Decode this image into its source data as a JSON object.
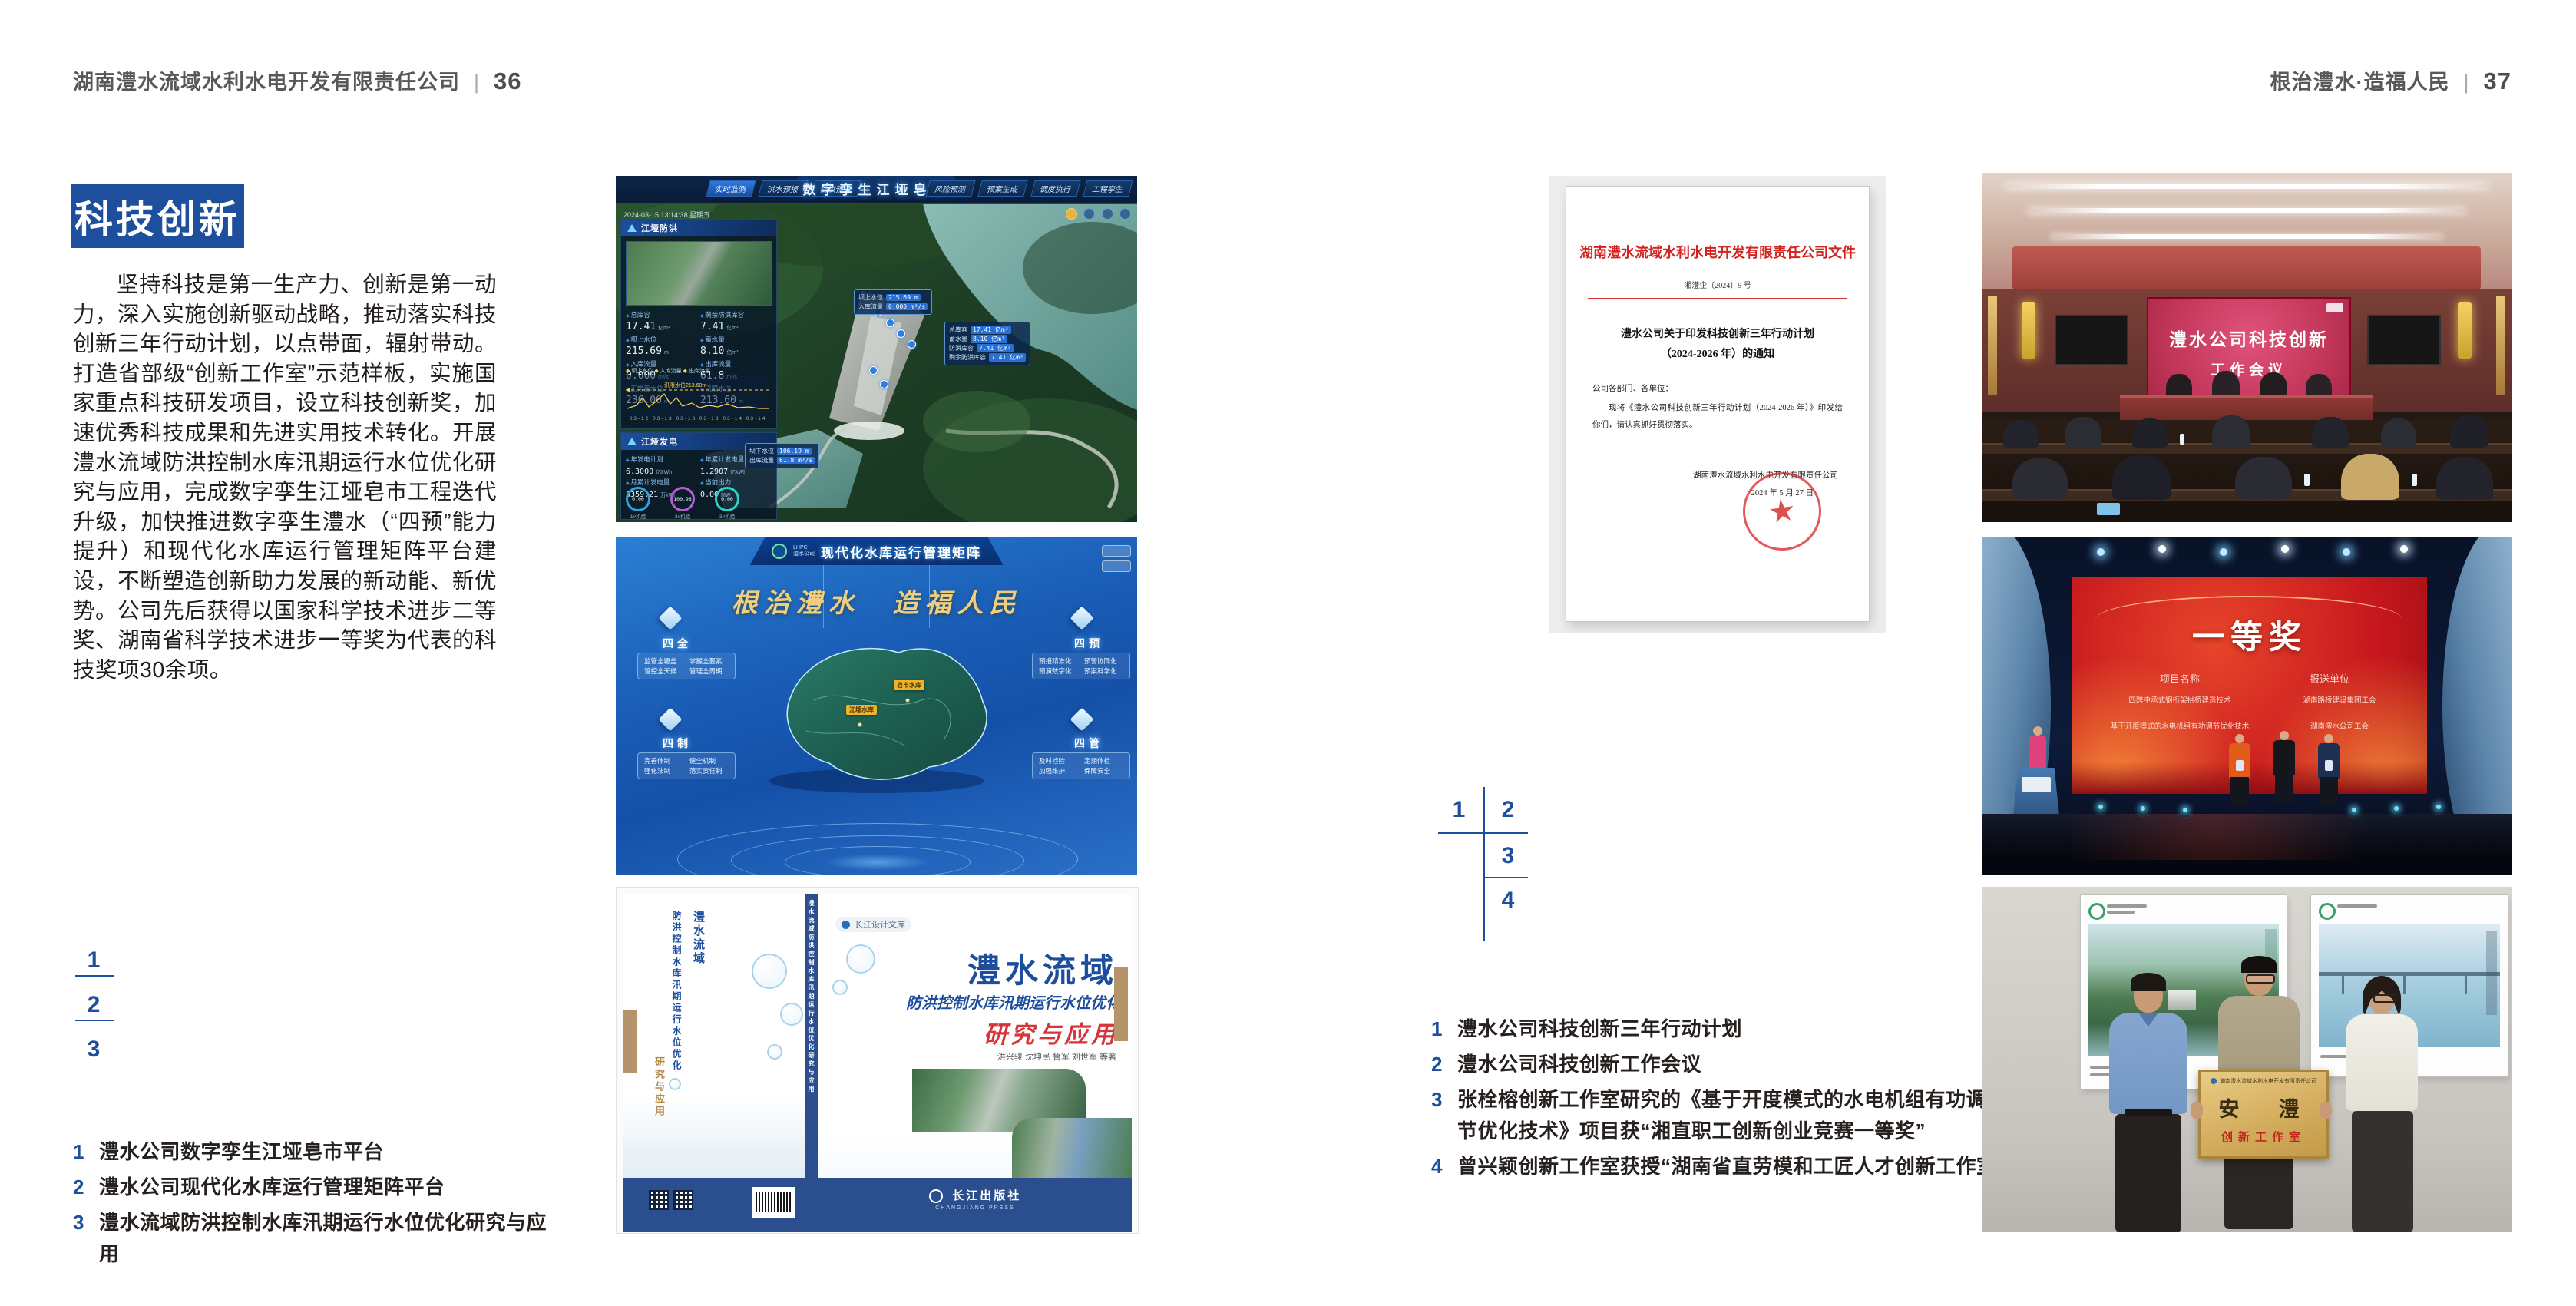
{
  "colors": {
    "accent_blue": "#1d4f9c",
    "doc_red": "#d42420",
    "gold": "#efce82",
    "award_red": "#c5161d"
  },
  "page_left": {
    "header": {
      "company": "湖南澧水流域水利水电开发有限责任公司",
      "sep": "|",
      "page": "36"
    },
    "section_title": "科技创新",
    "paragraph": "坚持科技是第一生产力、创新是第一动力，深入实施创新驱动战略，推动落实科技创新三年行动计划，以点带面，辐射带动。打造省部级“创新工作室”示范样板，实施国家重点科技研发项目，设立科技创新奖，加速优秀科技成果和先进实用技术转化。开展澧水流域防洪控制水库汛期运行水位优化研究与应用，完成数字孪生江垭皂市工程迭代升级，加快推进数字孪生澧水（“四预”能力提升）和现代化水库运行管理矩阵平台建设，不断塑造创新助力发展的新动能、新优势。公司先后获得以国家科学技术进步二等奖、湖南省科学技术进步一等奖为代表的科技奖项30余项。",
    "markers": [
      "1",
      "2",
      "3"
    ],
    "captions": [
      {
        "n": "1",
        "t": "澧水公司数字孪生江垭皂市平台"
      },
      {
        "n": "2",
        "t": "澧水公司现代化水库运行管理矩阵平台"
      },
      {
        "n": "3",
        "t": "澧水流域防洪控制水库汛期运行水位优化研究与应用"
      }
    ]
  },
  "page_right": {
    "header": {
      "slogan": "根治澧水·造福人民",
      "sep": "|",
      "page": "37"
    },
    "markers": [
      "1",
      "2",
      "3",
      "4"
    ],
    "captions": [
      {
        "n": "1",
        "t": "澧水公司科技创新三年行动计划"
      },
      {
        "n": "2",
        "t": "澧水公司科技创新工作会议"
      },
      {
        "n": "3",
        "t": "张栓榕创新工作室研究的《基于开度模式的水电机组有功调节优化技术》项目获“湘直职工创新创业竞赛一等奖”"
      },
      {
        "n": "4",
        "t": "曾兴颖创新工作室获授“湖南省直劳模和工匠人才创新工作室”"
      }
    ]
  },
  "twin": {
    "corner": "防洪兴利调度",
    "title": "数字孪生江垭皂市",
    "tabs_left": [
      "实时监测",
      "洪水预报",
      "防洪预演"
    ],
    "tabs_right": [
      "风险预测",
      "预案生成",
      "调度执行",
      "工程孪生"
    ],
    "datetime": "2024-03-15 13:14:38 星期五",
    "panel1_title": "江垭防洪",
    "stats1": [
      {
        "l": "总库容",
        "v": "17.41",
        "u": "亿m³"
      },
      {
        "l": "剩余防洪库容",
        "v": "7.41",
        "u": "亿m³"
      },
      {
        "l": "坝上水位",
        "v": "215.69",
        "u": "m"
      },
      {
        "l": "蓄水量",
        "v": "8.10",
        "u": "亿m³"
      },
      {
        "l": "入库流量",
        "v": "0.000",
        "u": "m³/s"
      },
      {
        "l": "出库流量",
        "v": "61.8",
        "u": "m³/s"
      },
      {
        "l": "正常蓄水位",
        "v": "236.00",
        "u": "m"
      },
      {
        "l": "汛限水位",
        "v": "213.60",
        "u": "m"
      }
    ],
    "legend": [
      "坝上水位",
      "入库流量",
      "出库流量"
    ],
    "chart_note": "汛限水位213.60m",
    "chart_x": "03-12  03-13  03-13  03-13  03-14  03-14",
    "panel2_title": "江垭发电",
    "stats2": [
      {
        "l": "年发电计划",
        "v": "6.3000",
        "u": "亿kWh"
      },
      {
        "l": "年累计发电量",
        "v": "1.2907",
        "u": "亿kWh"
      },
      {
        "l": "月累计发电量",
        "v": "3359.21",
        "u": "万kWh"
      },
      {
        "l": "当前出力",
        "v": "0.00",
        "u": "MW"
      },
      {
        "l": "发电流量",
        "v": "0.00",
        "u": "m³/s"
      },
      {
        "l": "弃水流量",
        "v": "0.00",
        "u": "m³/s"
      }
    ],
    "gauges": [
      {
        "v": "0.00",
        "l": "1#机组"
      },
      {
        "v": "100.98",
        "l": "2#机组"
      },
      {
        "v": "0.00",
        "l": "3#机组"
      }
    ],
    "tip1": {
      "rows": [
        {
          "l": "坝上水位",
          "v": "215.69 m"
        },
        {
          "l": "入库流量",
          "v": "0.000 m³/s"
        }
      ]
    },
    "tip2": {
      "rows": [
        {
          "l": "总库容",
          "v": "17.41 亿m³"
        },
        {
          "l": "蓄水量",
          "v": "8.10 亿m³"
        },
        {
          "l": "防洪库容",
          "v": "7.41 亿m³"
        },
        {
          "l": "剩余防洪库容",
          "v": "7.41 亿m³"
        }
      ]
    },
    "tip3": {
      "rows": [
        {
          "l": "坝下水位",
          "v": "106.19 m"
        },
        {
          "l": "出库流量",
          "v": "61.8 m³/s"
        }
      ]
    }
  },
  "matrix": {
    "logo": "LHPC",
    "logo_sub": "澧水公司",
    "title": "现代化水库运行管理矩阵",
    "slogan": "根治澧水　造福人民",
    "quads": [
      {
        "key": "四全",
        "items": [
          "监管全覆盖",
          "掌握全要素",
          "管控全天候",
          "管理全周期"
        ]
      },
      {
        "key": "四预",
        "items": [
          "预报精准化",
          "预警协同化",
          "预演数字化",
          "预案科学化"
        ]
      },
      {
        "key": "四制",
        "items": [
          "完善体制",
          "健全机制",
          "强化法制",
          "落实责任制"
        ]
      },
      {
        "key": "四管",
        "items": [
          "及时检险",
          "定期体检",
          "加强维护",
          "保障安全"
        ]
      }
    ],
    "map_labels": [
      "江垭水库",
      "皂市水库"
    ]
  },
  "book": {
    "series": "长江设计文库",
    "title1": "澧水流域",
    "title2": "防洪控制水库汛期运行水位优化",
    "title3": "研究与应用",
    "authors": "洪兴骏  沈坤民  鲁军  刘世军  等著",
    "spine": "澧水流域防洪控制水库汛期运行水位优化研究与应用",
    "publisher": "长江出版社",
    "publisher_en": "CHANGJIANG PRESS"
  },
  "doc": {
    "header": "湖南澧水流域水利水电开发有限责任公司文件",
    "number": "湘澧企〔2024〕9 号",
    "title_line1": "澧水公司关于印发科技创新三年行动计划",
    "title_line2": "（2024-2026 年）的通知",
    "salutation": "公司各部门、各单位：",
    "body": "现将《澧水公司科技创新三年行动计划（2024-2026 年）》印发给你们，请认真抓好贯彻落实。",
    "signer": "湖南澧水流域水利水电开发有限责任公司",
    "date": "2024 年 5 月 27 日"
  },
  "meeting": {
    "screen_line1": "澧水公司科技创新",
    "screen_line2": "工作会议"
  },
  "award": {
    "title": "一等奖",
    "col1": "项目名称",
    "col2": "报送单位",
    "rows": [
      {
        "p": "四跨中承式钢桁架拱桥建造技术",
        "u": "湖南路桥建设集团工会"
      },
      {
        "p": "基于开度模式的水电机组有功调节优化技术",
        "u": "湖南澧水公司工会"
      }
    ]
  },
  "plaque": {
    "org": "湖南澧水流域水利水电开发有限责任公司",
    "name": "安　澧",
    "sub": "创新工作室"
  }
}
